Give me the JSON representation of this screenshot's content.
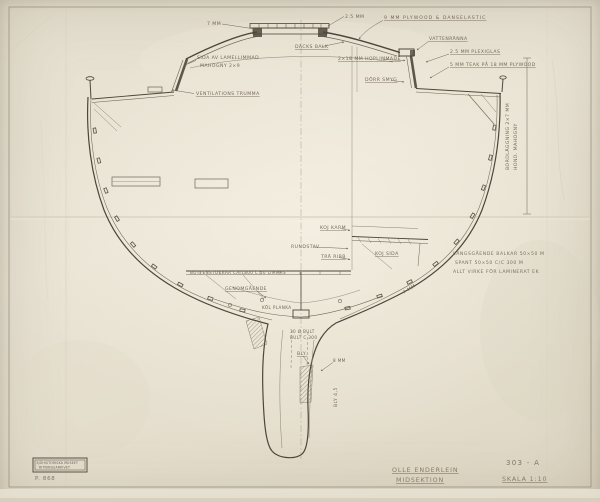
{
  "sheet": {
    "designer": "OLLE ENDERLEIN",
    "drawing_title": "MIDSEKTION",
    "drawing_number": "303 - A",
    "scale": "SKALA 1:10",
    "stamp": {
      "line1": "SJÖHISTORISKA MUSEET",
      "line2": "RITNINGSARKIVET",
      "number": "P. 868"
    },
    "annotations": {
      "roof_thickness": "7 MM",
      "hatch_glass_thickness": "2.5 MM",
      "roof_plywood": "9 MM PLYWOOD & DANSELASTIC",
      "water_channel": "VATTENRÄNNA",
      "plexiglas": "2.5 MM PLEXIGLAS",
      "deck_teak": "5 MM TEAK PÅ 18 MM PLYWOOD",
      "deck_beam": "DÄCKS BALK",
      "laminated_side": "2×18 MM HOPLIMMADE",
      "door_jamb": "DÖRR SMYG",
      "cabin_side_line1": "SIDA AV LAMELLIMMAD",
      "cabin_side_line2": "MAHOGNY 2×9",
      "ventilation_duct": "VENTILATIONS TRUMMA",
      "planking_line1": "BORDLÄGGNING 2×7 MM",
      "planking_line2": "HOND. MAHOGNY",
      "hull_thickness": "7 MM",
      "note_line1": "LÄNGSGÅENDE BALKAR 50×50 M",
      "note_line2": "SPANT 50×50 C/C 300 M",
      "note_line3": "ALLT VIRKE FÖR LAMINERAT EK",
      "berth_rail": "KOJ KARM",
      "round_bar": "RUNDSTAV",
      "wood_ribs": "TRÄ RIBB",
      "berth_side": "KOJ SIDA",
      "floor_timbers": "BOTTENSTOCKAR CA 1800 C 50 LIMMAS",
      "through_bolted": "GENOMGÅENDE",
      "keel_plank": "KÖL PLANKA",
      "keel_bolt_line1": "30 Ø BULT",
      "keel_bolt_line2": "BULT C 300",
      "lead": "BLY.",
      "keel_8mm": "8 MM",
      "ballast_weight": "BLY 4,5"
    }
  }
}
